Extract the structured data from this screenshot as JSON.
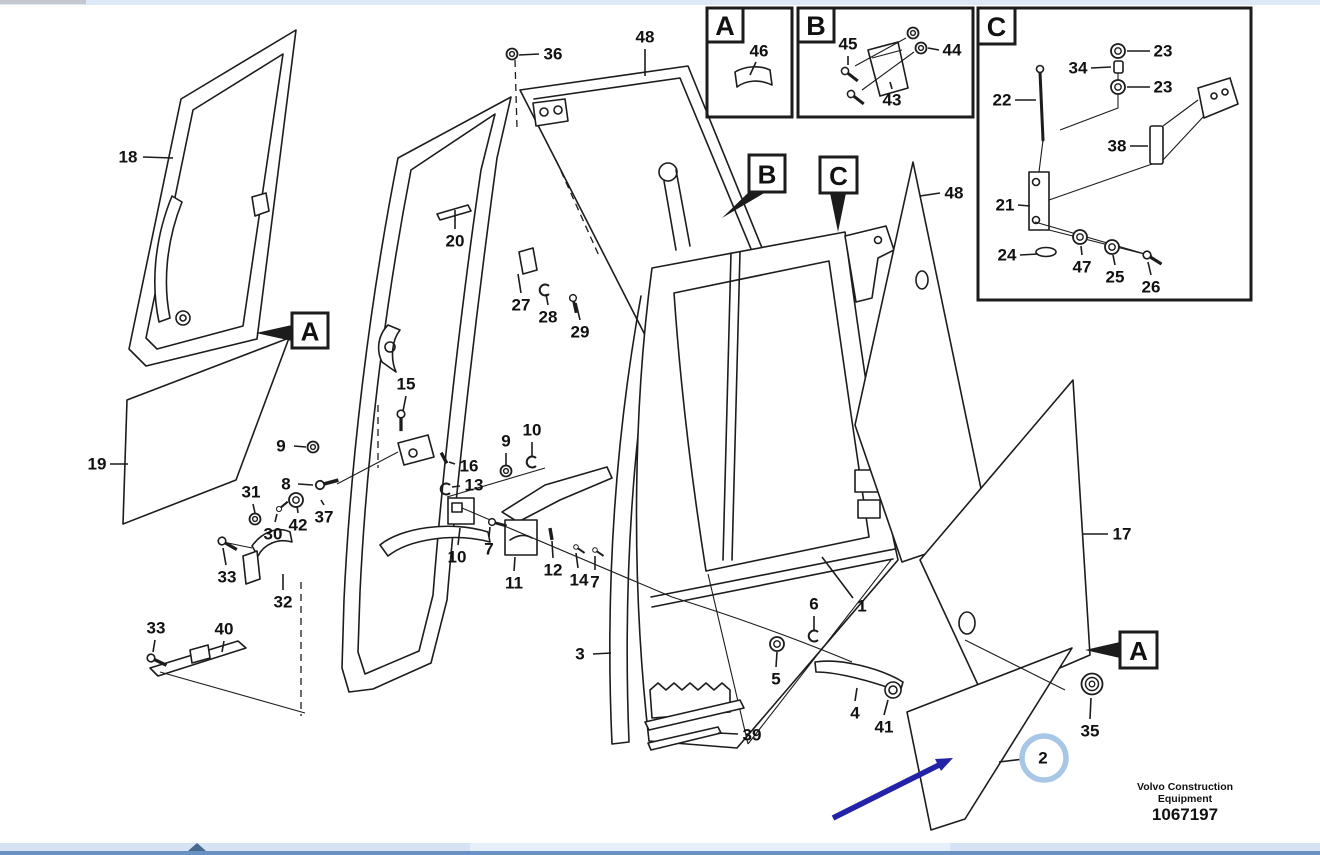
{
  "doc": {
    "brand_line1": "Volvo Construction",
    "brand_line2": "Equipment",
    "doc_number": "1067197"
  },
  "colors": {
    "line": "#1c1c1c",
    "label_text": "#111111",
    "annotation_arrow": "#2323a7",
    "highlight_circle": "#a8c6e6",
    "scroll_track": "#d5e3f4",
    "scroll_edge": "#6a91c3",
    "scroll_thumb": "#47688f",
    "top_strip": "#dde9f7"
  },
  "detail_views": [
    {
      "label": "A",
      "frame": [
        707,
        8,
        85,
        109
      ],
      "tab": [
        707,
        8,
        36,
        34
      ]
    },
    {
      "label": "B",
      "frame": [
        798,
        8,
        175,
        109
      ],
      "tab": [
        798,
        8,
        36,
        34
      ]
    },
    {
      "label": "C",
      "frame": [
        978,
        8,
        273,
        292
      ],
      "tab": [
        978,
        8,
        37,
        36
      ]
    }
  ],
  "callout_markers": [
    {
      "label": "A",
      "box": [
        292,
        313,
        36,
        35
      ],
      "arrow": [
        [
          292,
          325
        ],
        [
          292,
          341
        ],
        [
          256,
          333
        ]
      ]
    },
    {
      "label": "B",
      "box": [
        749,
        155,
        36,
        37
      ],
      "arrow": [
        [
          751,
          190
        ],
        [
          766,
          192
        ],
        [
          722,
          218
        ]
      ]
    },
    {
      "label": "C",
      "box": [
        820,
        157,
        37,
        36
      ],
      "arrow": [
        [
          830,
          193
        ],
        [
          846,
          193
        ],
        [
          838,
          232
        ]
      ]
    },
    {
      "label": "A",
      "box": [
        1120,
        632,
        37,
        36
      ],
      "arrow": [
        [
          1120,
          642
        ],
        [
          1120,
          658
        ],
        [
          1085,
          650
        ]
      ]
    }
  ],
  "part_labels": [
    {
      "text": "18",
      "x": 128,
      "y": 157,
      "leader": [
        143,
        157,
        173,
        158
      ]
    },
    {
      "text": "19",
      "x": 97,
      "y": 464,
      "leader": [
        110,
        464,
        128,
        464
      ]
    },
    {
      "text": "36",
      "x": 553,
      "y": 54,
      "leader": [
        539,
        54,
        519,
        55
      ]
    },
    {
      "text": "48",
      "x": 645,
      "y": 37,
      "leader": [
        645,
        49,
        645,
        76
      ]
    },
    {
      "text": "20",
      "x": 455,
      "y": 241,
      "leader": [
        455,
        229,
        455,
        210
      ]
    },
    {
      "text": "27",
      "x": 521,
      "y": 305,
      "leader": [
        521,
        293,
        518,
        274
      ]
    },
    {
      "text": "28",
      "x": 548,
      "y": 317,
      "leader": [
        548,
        305,
        546,
        294
      ]
    },
    {
      "text": "29",
      "x": 580,
      "y": 332,
      "leader": [
        580,
        320,
        576,
        303
      ]
    },
    {
      "text": "15",
      "x": 406,
      "y": 384,
      "leader": [
        406,
        396,
        403,
        411
      ]
    },
    {
      "text": "9",
      "x": 281,
      "y": 446,
      "leader": [
        294,
        446,
        306,
        447
      ]
    },
    {
      "text": "8",
      "x": 286,
      "y": 484,
      "leader": [
        298,
        484,
        313,
        485
      ]
    },
    {
      "text": "31",
      "x": 251,
      "y": 492,
      "leader": [
        253,
        504,
        255,
        513
      ]
    },
    {
      "text": "30",
      "x": 273,
      "y": 534,
      "leader": [
        275,
        522,
        277,
        514
      ]
    },
    {
      "text": "42",
      "x": 298,
      "y": 525,
      "leader": [
        298,
        513,
        297,
        506
      ]
    },
    {
      "text": "37",
      "x": 324,
      "y": 517,
      "leader": [
        324,
        505,
        321,
        500
      ]
    },
    {
      "text": "33",
      "x": 227,
      "y": 577,
      "leader": [
        226,
        565,
        223,
        548
      ]
    },
    {
      "text": "32",
      "x": 283,
      "y": 602,
      "leader": [
        283,
        590,
        283,
        574
      ]
    },
    {
      "text": "33",
      "x": 156,
      "y": 628,
      "leader": [
        155,
        640,
        153,
        652
      ]
    },
    {
      "text": "40",
      "x": 224,
      "y": 629,
      "leader": [
        224,
        641,
        222,
        652
      ]
    },
    {
      "text": "16",
      "x": 469,
      "y": 466,
      "leader": [
        455,
        464,
        449,
        462
      ]
    },
    {
      "text": "13",
      "x": 474,
      "y": 485,
      "leader": [
        460,
        486,
        452,
        487
      ]
    },
    {
      "text": "9",
      "x": 506,
      "y": 441,
      "leader": [
        506,
        453,
        506,
        466
      ]
    },
    {
      "text": "10",
      "x": 532,
      "y": 430,
      "leader": [
        532,
        442,
        532,
        457
      ]
    },
    {
      "text": "10",
      "x": 457,
      "y": 557,
      "leader": [
        458,
        545,
        460,
        528
      ]
    },
    {
      "text": "7",
      "x": 489,
      "y": 549,
      "leader": [
        489,
        537,
        490,
        527
      ]
    },
    {
      "text": "11",
      "x": 514,
      "y": 583,
      "leader": [
        514,
        571,
        515,
        557
      ]
    },
    {
      "text": "12",
      "x": 553,
      "y": 570,
      "leader": [
        553,
        558,
        552,
        541
      ]
    },
    {
      "text": "14",
      "x": 579,
      "y": 580,
      "leader": [
        578,
        568,
        576,
        553
      ]
    },
    {
      "text": "7",
      "x": 595,
      "y": 582,
      "leader": [
        595,
        570,
        595,
        556
      ]
    },
    {
      "text": "1",
      "x": 862,
      "y": 606,
      "leader": [
        853,
        598,
        822,
        557
      ]
    },
    {
      "text": "3",
      "x": 580,
      "y": 654,
      "leader": [
        593,
        654,
        611,
        653
      ]
    },
    {
      "text": "5",
      "x": 776,
      "y": 679,
      "leader": [
        776,
        667,
        777,
        652
      ]
    },
    {
      "text": "6",
      "x": 814,
      "y": 604,
      "leader": [
        814,
        616,
        814,
        630
      ]
    },
    {
      "text": "4",
      "x": 855,
      "y": 713,
      "leader": [
        855,
        701,
        857,
        688
      ]
    },
    {
      "text": "41",
      "x": 884,
      "y": 727,
      "leader": [
        884,
        715,
        888,
        700
      ]
    },
    {
      "text": "39",
      "x": 752,
      "y": 735,
      "leader": [
        738,
        734,
        718,
        733
      ]
    },
    {
      "text": "48",
      "x": 954,
      "y": 193,
      "leader": [
        940,
        193,
        920,
        196
      ]
    },
    {
      "text": "17",
      "x": 1122,
      "y": 534,
      "leader": [
        1108,
        534,
        1083,
        534
      ]
    },
    {
      "text": "35",
      "x": 1090,
      "y": 731,
      "leader": [
        1090,
        719,
        1091,
        698
      ]
    },
    {
      "text": "2",
      "x": 1043,
      "y": 758,
      "leader": [
        1024,
        759,
        999,
        762
      ]
    },
    {
      "text": "46",
      "x": 759,
      "y": 51,
      "leader": [
        756,
        62,
        750,
        75
      ]
    },
    {
      "text": "45",
      "x": 848,
      "y": 44,
      "leader": [
        848,
        56,
        848,
        65
      ]
    },
    {
      "text": "44",
      "x": 952,
      "y": 50,
      "leader": [
        939,
        50,
        928,
        48
      ]
    },
    {
      "text": "43",
      "x": 892,
      "y": 100,
      "leader": [
        892,
        89,
        890,
        82
      ]
    },
    {
      "text": "23",
      "x": 1163,
      "y": 51,
      "leader": [
        1150,
        51,
        1127,
        51
      ]
    },
    {
      "text": "34",
      "x": 1078,
      "y": 68,
      "leader": [
        1091,
        68,
        1111,
        67
      ]
    },
    {
      "text": "23",
      "x": 1163,
      "y": 87,
      "leader": [
        1150,
        87,
        1127,
        87
      ]
    },
    {
      "text": "22",
      "x": 1002,
      "y": 100,
      "leader": [
        1015,
        100,
        1036,
        100
      ]
    },
    {
      "text": "38",
      "x": 1117,
      "y": 146,
      "leader": [
        1130,
        146,
        1148,
        146
      ]
    },
    {
      "text": "21",
      "x": 1005,
      "y": 205,
      "leader": [
        1018,
        205,
        1030,
        206
      ]
    },
    {
      "text": "24",
      "x": 1007,
      "y": 255,
      "leader": [
        1020,
        255,
        1038,
        254
      ]
    },
    {
      "text": "47",
      "x": 1082,
      "y": 267,
      "leader": [
        1082,
        255,
        1081,
        246
      ]
    },
    {
      "text": "25",
      "x": 1115,
      "y": 277,
      "leader": [
        1115,
        265,
        1113,
        255
      ]
    },
    {
      "text": "26",
      "x": 1151,
      "y": 287,
      "leader": [
        1151,
        275,
        1148,
        262
      ]
    }
  ],
  "hardware": [
    {
      "type": "nut",
      "x": 512,
      "y": 54
    },
    {
      "type": "nut",
      "x": 313,
      "y": 447
    },
    {
      "type": "bolt",
      "x": 320,
      "y": 485,
      "rot": -15,
      "scale": 1
    },
    {
      "type": "nut",
      "x": 255,
      "y": 519
    },
    {
      "type": "bolt",
      "x": 279,
      "y": 509,
      "rot": -40,
      "scale": 0.6
    },
    {
      "type": "washer",
      "x": 296,
      "y": 500
    },
    {
      "type": "nut",
      "x": 506,
      "y": 471
    },
    {
      "type": "clip",
      "x": 532,
      "y": 462
    },
    {
      "type": "pin",
      "x": 444,
      "y": 458,
      "rot": 62
    },
    {
      "type": "clip",
      "x": 446,
      "y": 489
    },
    {
      "type": "bolt",
      "x": 492,
      "y": 522,
      "rot": 15,
      "scale": 0.8
    },
    {
      "type": "pin",
      "x": 551,
      "y": 534,
      "rot": 80
    },
    {
      "type": "bolt",
      "x": 576,
      "y": 547,
      "rot": 35,
      "scale": 0.55
    },
    {
      "type": "bolt",
      "x": 595,
      "y": 550,
      "rot": 35,
      "scale": 0.55
    },
    {
      "type": "bolt",
      "x": 401,
      "y": 414,
      "rot": 90,
      "scale": 0.9
    },
    {
      "type": "bolt",
      "x": 573,
      "y": 298,
      "rot": 78,
      "scale": 0.8
    },
    {
      "type": "clip",
      "x": 545,
      "y": 290
    },
    {
      "type": "washer",
      "x": 777,
      "y": 644
    },
    {
      "type": "clip",
      "x": 814,
      "y": 636
    },
    {
      "type": "grommet",
      "x": 1092,
      "y": 684
    },
    {
      "type": "bolt",
      "x": 222,
      "y": 541,
      "rot": 30,
      "scale": 0.9
    },
    {
      "type": "bolt",
      "x": 151,
      "y": 658,
      "rot": 25,
      "scale": 0.9
    },
    {
      "type": "bolt",
      "x": 845,
      "y": 71,
      "rot": 38,
      "scale": 0.85
    },
    {
      "type": "bolt",
      "x": 851,
      "y": 94,
      "rot": 38,
      "scale": 0.85
    },
    {
      "type": "nut",
      "x": 913,
      "y": 33
    },
    {
      "type": "nut",
      "x": 921,
      "y": 48
    },
    {
      "type": "washer",
      "x": 1118,
      "y": 51
    },
    {
      "type": "washer",
      "x": 1118,
      "y": 87
    },
    {
      "type": "washer",
      "x": 1080,
      "y": 237
    },
    {
      "type": "washer",
      "x": 1112,
      "y": 247
    },
    {
      "type": "bolt",
      "x": 1147,
      "y": 255,
      "rot": 32,
      "scale": 0.9
    }
  ],
  "annotations": {
    "pointer_arrow": {
      "x1": 833,
      "y1": 818,
      "x2": 941,
      "y2": 764,
      "head": [
        [
          953,
          758
        ],
        [
          941,
          771
        ],
        [
          935,
          759
        ]
      ]
    },
    "highlight_circle": {
      "cx": 1044,
      "cy": 758,
      "r": 22
    }
  },
  "scrollbar": {
    "thumb_left": 188
  }
}
